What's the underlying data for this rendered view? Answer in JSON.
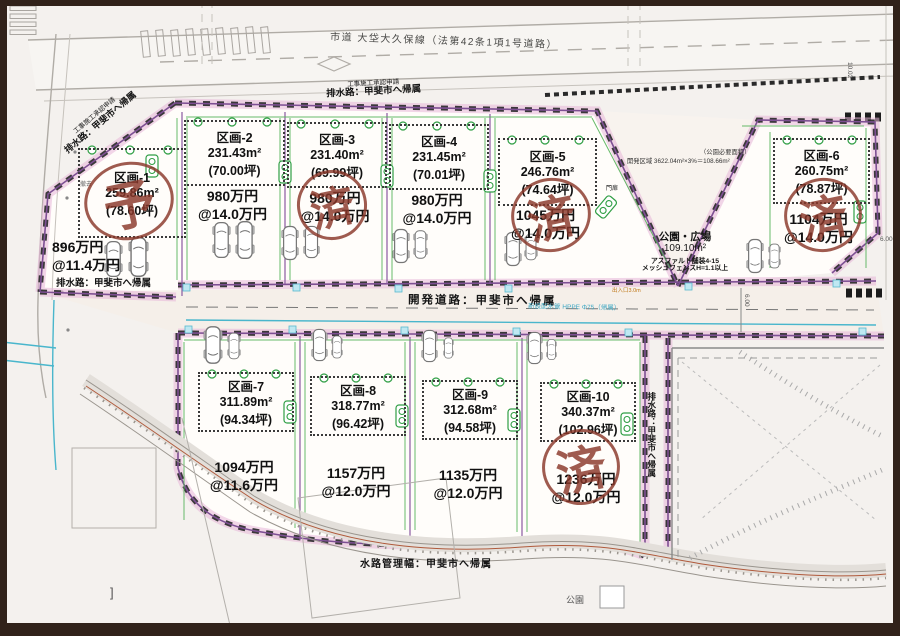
{
  "labels": {
    "road_top": "市道 大垈大久保線（法第42条1項1号道路）",
    "approval": "工事施工承認申請",
    "drain": "排水路：甲斐市へ帰属",
    "dev_road": "開発道路：甲斐市へ帰属",
    "pipe": "新設配水管 HPPE Φ75（帰属）",
    "channel_width": "水路管理幅：甲斐市へ帰属",
    "park_small": "公園",
    "park_req_title": "（公園必要面積）",
    "park_req": "開発区域 3622.04m²×3%＝108.66m²",
    "gate": "門扉",
    "entrance": "出入口3.0m",
    "removal": "撤去",
    "bracket": "]"
  },
  "park": {
    "name": "公園・広場",
    "area": "109.10m²",
    "note1": "アスファルト舗装4-15",
    "note2": "メッシュフェンスH=1.1以上"
  },
  "dims": {
    "a": "10.02",
    "b": "6.00",
    "c": "6.00"
  },
  "plots": [
    {
      "name": "区画-1",
      "area": "259.86m²",
      "tsubo": "(78.60坪)",
      "price": "896万円",
      "unit": "@11.4万円",
      "stamp": "予"
    },
    {
      "name": "区画-2",
      "area": "231.43m²",
      "tsubo": "(70.00坪)",
      "price": "980万円",
      "unit": "@14.0万円"
    },
    {
      "name": "区画-3",
      "area": "231.40m²",
      "tsubo": "(69.99坪)",
      "price": "980万円",
      "unit": "@14.0万円",
      "stamp": "済"
    },
    {
      "name": "区画-4",
      "area": "231.45m²",
      "tsubo": "(70.01坪)",
      "price": "980万円",
      "unit": "@14.0万円"
    },
    {
      "name": "区画-5",
      "area": "246.76m²",
      "tsubo": "(74.64坪)",
      "price": "1045万円",
      "unit": "@14.0万円",
      "stamp": "済"
    },
    {
      "name": "区画-6",
      "area": "260.75m²",
      "tsubo": "(78.87坪)",
      "price": "1104万円",
      "unit": "@14.0万円",
      "stamp": "済"
    },
    {
      "name": "区画-7",
      "area": "311.89m²",
      "tsubo": "(94.34坪)",
      "price": "1094万円",
      "unit": "@11.6万円"
    },
    {
      "name": "区画-8",
      "area": "318.77m²",
      "tsubo": "(96.42坪)",
      "price": "1157万円",
      "unit": "@12.0万円"
    },
    {
      "name": "区画-9",
      "area": "312.68m²",
      "tsubo": "(94.58坪)",
      "price": "1135万円",
      "unit": "@12.0万円"
    },
    {
      "name": "区画-10",
      "area": "340.37m²",
      "tsubo": "(102.96坪)",
      "price": "1236万円",
      "unit": "@12.0万円",
      "stamp": "済"
    }
  ]
}
